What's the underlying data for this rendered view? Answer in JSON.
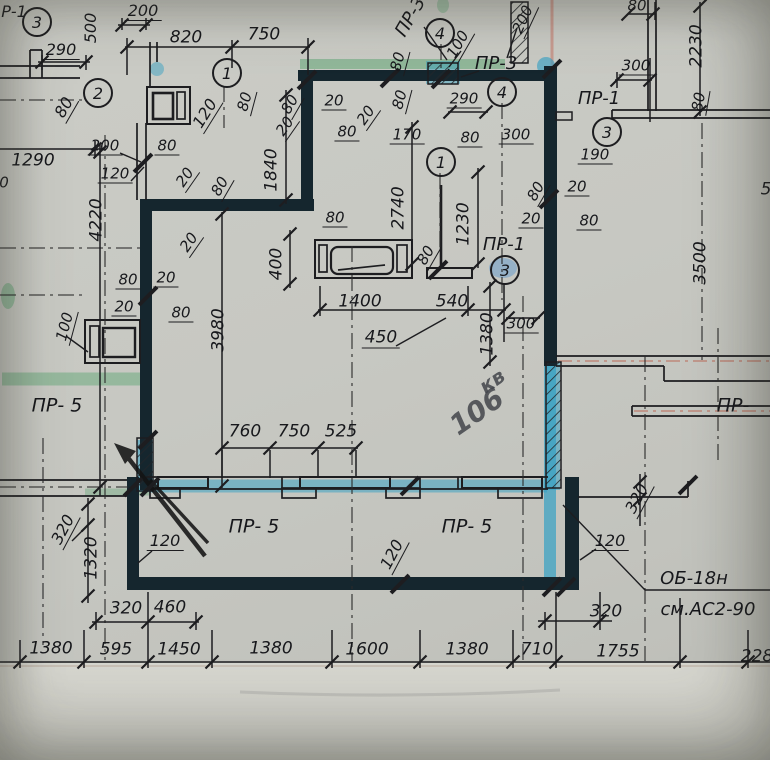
{
  "drawing_type": "scanned construction floor plan (panel layout)",
  "colors": {
    "paper": "#c7c8c2",
    "ink": "#1d1d20",
    "highlight_blue": "#2f9fc4",
    "highlight_green": "#63a877",
    "wall_core": "#15262e",
    "pink_scan_line": "#c4604f",
    "pencil": "#141414"
  },
  "axis_circles": [
    {
      "n": "3",
      "x": 35,
      "y": 20
    },
    {
      "n": "2",
      "x": 96,
      "y": 91
    },
    {
      "n": "1",
      "x": 225,
      "y": 71
    },
    {
      "n": "4",
      "x": 438,
      "y": 31
    },
    {
      "n": "4",
      "x": 500,
      "y": 90
    },
    {
      "n": "1",
      "x": 439,
      "y": 160
    },
    {
      "n": "3",
      "x": 605,
      "y": 130
    },
    {
      "n": "3",
      "x": 503,
      "y": 268
    }
  ],
  "handwriting": [
    {
      "t": "кв",
      "x": 492,
      "y": 381,
      "r": -35,
      "s": 20
    },
    {
      "t": "106",
      "x": 477,
      "y": 412,
      "r": -35,
      "s": 28
    }
  ],
  "labels": [
    {
      "t": "Р-1",
      "x": 14,
      "y": 12,
      "r": 0,
      "s": 16
    },
    {
      "t": "290",
      "x": 61,
      "y": 51,
      "r": 0,
      "s": 16,
      "sh": 1
    },
    {
      "t": "500",
      "x": 91,
      "y": 28,
      "r": -90,
      "s": 16
    },
    {
      "t": "200",
      "x": 143,
      "y": 12,
      "r": 0,
      "s": 16,
      "sh": 1
    },
    {
      "t": "820",
      "x": 186,
      "y": 38,
      "r": 0,
      "s": 17
    },
    {
      "t": "750",
      "x": 264,
      "y": 35,
      "r": 0,
      "s": 17
    },
    {
      "t": "80",
      "x": 65,
      "y": 108,
      "r": -60,
      "s": 16,
      "sh": 1
    },
    {
      "t": "120",
      "x": 206,
      "y": 114,
      "r": -58,
      "s": 16,
      "sh": 1
    },
    {
      "t": "1290",
      "x": 33,
      "y": 161,
      "r": 0,
      "s": 17
    },
    {
      "t": "0",
      "x": 4,
      "y": 183,
      "r": 0,
      "s": 15
    },
    {
      "t": "200",
      "x": 105,
      "y": 147,
      "r": 0,
      "s": 15,
      "sh": 1
    },
    {
      "t": "120",
      "x": 115,
      "y": 175,
      "r": 0,
      "s": 15,
      "sh": 1
    },
    {
      "t": "80",
      "x": 167,
      "y": 147,
      "r": 0,
      "s": 15,
      "sh": 1
    },
    {
      "t": "4220",
      "x": 97,
      "y": 220,
      "r": -90,
      "s": 17
    },
    {
      "t": "20",
      "x": 186,
      "y": 178,
      "r": -55,
      "s": 15,
      "sh": 1
    },
    {
      "t": "80",
      "x": 221,
      "y": 187,
      "r": -60,
      "s": 15,
      "sh": 1
    },
    {
      "t": "20",
      "x": 190,
      "y": 243,
      "r": -55,
      "s": 15,
      "sh": 1
    },
    {
      "t": "80",
      "x": 128,
      "y": 281,
      "r": 0,
      "s": 15,
      "sh": 1
    },
    {
      "t": "20",
      "x": 166,
      "y": 279,
      "r": 0,
      "s": 15,
      "sh": 1
    },
    {
      "t": "20",
      "x": 124,
      "y": 308,
      "r": 0,
      "s": 15,
      "sh": 1
    },
    {
      "t": "80",
      "x": 181,
      "y": 314,
      "r": 0,
      "s": 15,
      "sh": 1
    },
    {
      "t": "100",
      "x": 66,
      "y": 327,
      "r": -75,
      "s": 15,
      "sh": 1
    },
    {
      "t": "3980",
      "x": 219,
      "y": 330,
      "r": -90,
      "s": 17
    },
    {
      "t": "ПР- 5",
      "x": 57,
      "y": 406,
      "r": 0,
      "s": 19
    },
    {
      "t": "320",
      "x": 64,
      "y": 530,
      "r": -62,
      "s": 16,
      "sh": 1
    },
    {
      "t": "1320",
      "x": 92,
      "y": 558,
      "r": -90,
      "s": 17
    },
    {
      "t": "120",
      "x": 165,
      "y": 542,
      "r": 0,
      "s": 16,
      "sh": 1
    },
    {
      "t": "320",
      "x": 126,
      "y": 609,
      "r": 0,
      "s": 17
    },
    {
      "t": "460",
      "x": 170,
      "y": 608,
      "r": 0,
      "s": 17
    },
    {
      "t": "1380",
      "x": 51,
      "y": 649,
      "r": 0,
      "s": 17
    },
    {
      "t": "595",
      "x": 116,
      "y": 650,
      "r": 0,
      "s": 17
    },
    {
      "t": "1450",
      "x": 179,
      "y": 650,
      "r": 0,
      "s": 17
    },
    {
      "t": "1380",
      "x": 271,
      "y": 649,
      "r": 0,
      "s": 17
    },
    {
      "t": "1600",
      "x": 367,
      "y": 650,
      "r": 0,
      "s": 17
    },
    {
      "t": "1380",
      "x": 467,
      "y": 650,
      "r": 0,
      "s": 17
    },
    {
      "t": "710",
      "x": 537,
      "y": 650,
      "r": 0,
      "s": 17
    },
    {
      "t": "1755",
      "x": 618,
      "y": 652,
      "r": 0,
      "s": 17
    },
    {
      "t": "228",
      "x": 757,
      "y": 657,
      "r": 0,
      "s": 17
    },
    {
      "t": "760",
      "x": 245,
      "y": 432,
      "r": 0,
      "s": 17
    },
    {
      "t": "750",
      "x": 294,
      "y": 432,
      "r": 0,
      "s": 17
    },
    {
      "t": "525",
      "x": 341,
      "y": 432,
      "r": 0,
      "s": 17
    },
    {
      "t": "ПР- 5",
      "x": 254,
      "y": 527,
      "r": 0,
      "s": 19
    },
    {
      "t": "ПР- 5",
      "x": 467,
      "y": 527,
      "r": 0,
      "s": 19
    },
    {
      "t": "120",
      "x": 393,
      "y": 555,
      "r": -62,
      "s": 16,
      "sh": 1
    },
    {
      "t": "ПР-",
      "x": 733,
      "y": 406,
      "r": 0,
      "s": 19
    },
    {
      "t": "320",
      "x": 638,
      "y": 499,
      "r": -62,
      "s": 16,
      "sh": 1
    },
    {
      "t": "120",
      "x": 610,
      "y": 542,
      "r": 0,
      "s": 16,
      "sh": 1
    },
    {
      "t": "320",
      "x": 606,
      "y": 612,
      "r": 0,
      "s": 17
    },
    {
      "t": "ОБ-18н",
      "x": 694,
      "y": 579,
      "r": 0,
      "s": 18
    },
    {
      "t": "см.АС2-90",
      "x": 708,
      "y": 610,
      "r": 0,
      "s": 18
    },
    {
      "t": "1400",
      "x": 360,
      "y": 302,
      "r": 0,
      "s": 17
    },
    {
      "t": "540",
      "x": 452,
      "y": 302,
      "r": 0,
      "s": 17
    },
    {
      "t": "450",
      "x": 381,
      "y": 339,
      "r": 0,
      "s": 17,
      "sh": 1
    },
    {
      "t": "300",
      "x": 521,
      "y": 325,
      "r": 0,
      "s": 15,
      "sh": 1
    },
    {
      "t": "1380",
      "x": 488,
      "y": 334,
      "r": -90,
      "s": 17
    },
    {
      "t": "ПР-1",
      "x": 504,
      "y": 245,
      "r": 0,
      "s": 18
    },
    {
      "t": "2740",
      "x": 399,
      "y": 208,
      "r": -90,
      "s": 17
    },
    {
      "t": "1230",
      "x": 464,
      "y": 224,
      "r": -90,
      "s": 17
    },
    {
      "t": "1840",
      "x": 272,
      "y": 170,
      "r": -90,
      "s": 17
    },
    {
      "t": "400",
      "x": 277,
      "y": 264,
      "r": -90,
      "s": 17
    },
    {
      "t": "80",
      "x": 335,
      "y": 219,
      "r": 0,
      "s": 15,
      "sh": 1
    },
    {
      "t": "80",
      "x": 427,
      "y": 256,
      "r": -60,
      "s": 15,
      "sh": 1
    },
    {
      "t": "3500",
      "x": 701,
      "y": 263,
      "r": -90,
      "s": 17
    },
    {
      "t": "20",
      "x": 334,
      "y": 102,
      "r": 0,
      "s": 15,
      "sh": 1
    },
    {
      "t": "20",
      "x": 367,
      "y": 116,
      "r": -55,
      "s": 15,
      "sh": 1
    },
    {
      "t": "80",
      "x": 401,
      "y": 100,
      "r": -75,
      "s": 15,
      "sh": 1
    },
    {
      "t": "80",
      "x": 347,
      "y": 133,
      "r": 0,
      "s": 15,
      "sh": 1
    },
    {
      "t": "170",
      "x": 407,
      "y": 136,
      "r": 0,
      "s": 15,
      "sh": 1
    },
    {
      "t": "80",
      "x": 291,
      "y": 105,
      "r": -60,
      "s": 15,
      "sh": 1
    },
    {
      "t": "20",
      "x": 286,
      "y": 127,
      "r": -55,
      "s": 15,
      "sh": 1
    },
    {
      "t": "80",
      "x": 246,
      "y": 102,
      "r": -75,
      "s": 15,
      "sh": 1
    },
    {
      "t": "290",
      "x": 464,
      "y": 100,
      "r": 0,
      "s": 15,
      "sh": 1
    },
    {
      "t": "80",
      "x": 470,
      "y": 139,
      "r": 0,
      "s": 15,
      "sh": 1
    },
    {
      "t": "300",
      "x": 516,
      "y": 136,
      "r": 0,
      "s": 15,
      "sh": 1
    },
    {
      "t": "100",
      "x": 459,
      "y": 45,
      "r": -60,
      "s": 15,
      "sh": 1
    },
    {
      "t": "200",
      "x": 524,
      "y": 20,
      "r": -65,
      "s": 15,
      "sh": 1
    },
    {
      "t": "ПР-3",
      "x": 411,
      "y": 17,
      "r": -60,
      "s": 18
    },
    {
      "t": "ПР-3",
      "x": 496,
      "y": 64,
      "r": 0,
      "s": 18
    },
    {
      "t": "80",
      "x": 399,
      "y": 62,
      "r": -75,
      "s": 15,
      "sh": 1
    },
    {
      "t": "80",
      "x": 637,
      "y": 6,
      "r": 0,
      "s": 15
    },
    {
      "t": "2230",
      "x": 697,
      "y": 46,
      "r": -90,
      "s": 17
    },
    {
      "t": "300",
      "x": 636,
      "y": 67,
      "r": 0,
      "s": 15,
      "sh": 1
    },
    {
      "t": "80",
      "x": 700,
      "y": 102,
      "r": -80,
      "s": 15,
      "sh": 1
    },
    {
      "t": "ПР-1",
      "x": 599,
      "y": 99,
      "r": 0,
      "s": 18
    },
    {
      "t": "190",
      "x": 595,
      "y": 156,
      "r": 0,
      "s": 15,
      "sh": 1
    },
    {
      "t": "20",
      "x": 577,
      "y": 188,
      "r": 0,
      "s": 15,
      "sh": 1
    },
    {
      "t": "80",
      "x": 537,
      "y": 192,
      "r": -60,
      "s": 15,
      "sh": 1
    },
    {
      "t": "20",
      "x": 531,
      "y": 220,
      "r": 0,
      "s": 15,
      "sh": 1
    },
    {
      "t": "80",
      "x": 589,
      "y": 222,
      "r": 0,
      "s": 15,
      "sh": 1
    },
    {
      "t": "5",
      "x": 766,
      "y": 190,
      "r": 0,
      "s": 17
    }
  ]
}
